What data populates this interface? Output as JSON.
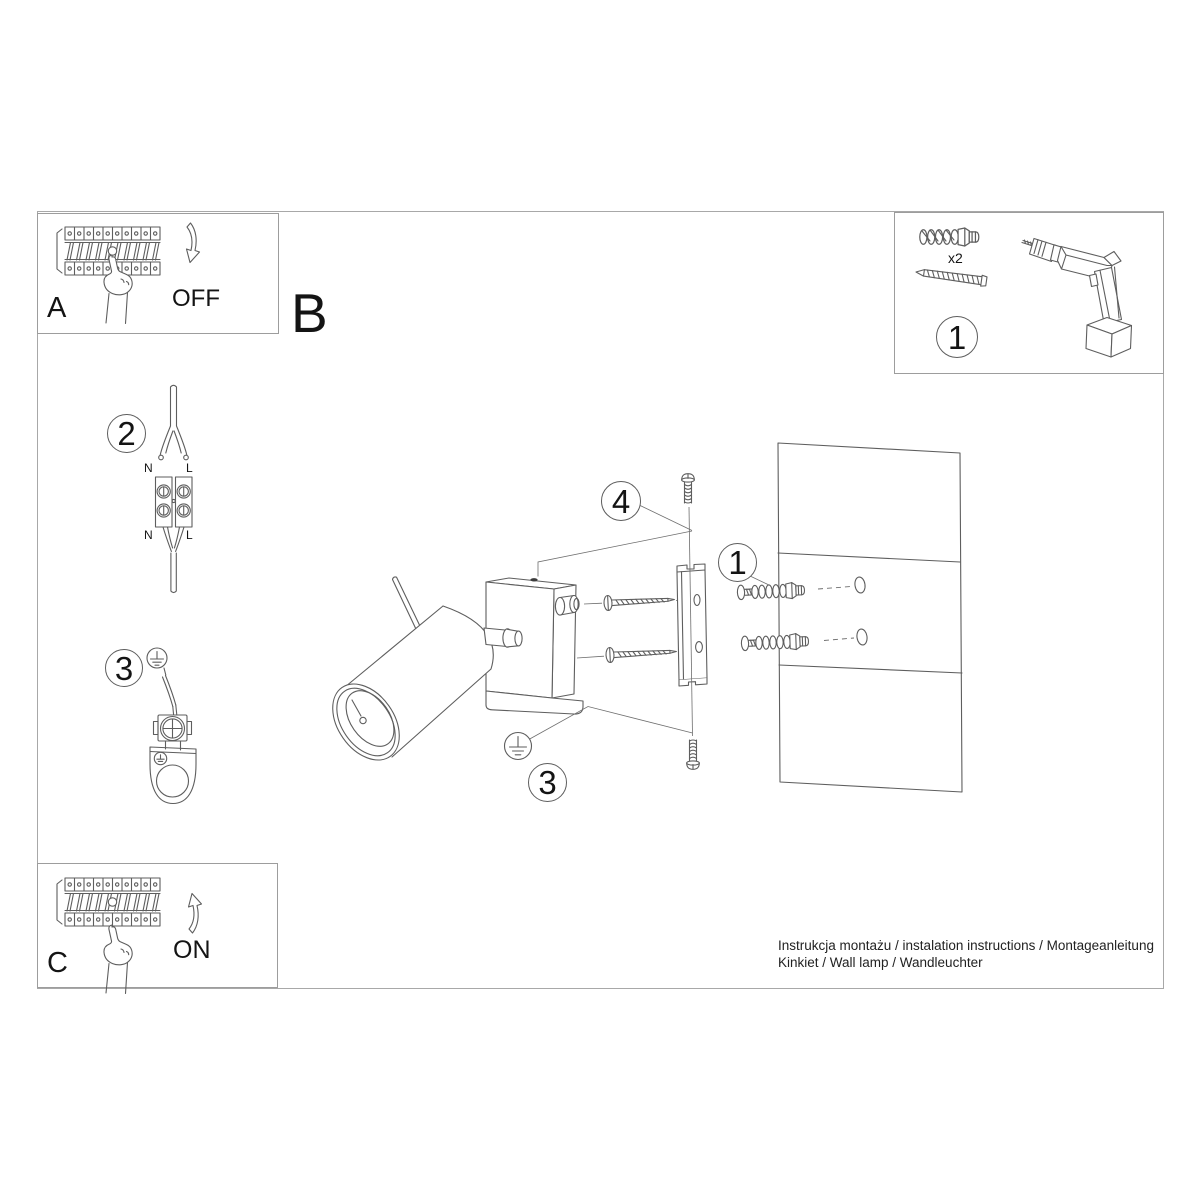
{
  "doc": {
    "title_line1": "Instrukcja montażu / instalation instructions / Montageanleitung",
    "title_line2": "Kinkiet / Wall lamp / Wandleuchter"
  },
  "labels": {
    "step_a": "A",
    "step_b": "B",
    "step_c": "C",
    "off": "OFF",
    "on": "ON",
    "qty": "x2",
    "n_top": "N",
    "l_top": "L",
    "n_bottom": "N",
    "l_bottom": "L"
  },
  "callouts": {
    "tools": "1",
    "wiring": "2",
    "earth_left": "3",
    "screw_top": "4",
    "anchors": "1",
    "earth_main": "3"
  },
  "colors": {
    "line": "#5e5e5e",
    "frame": "#a8a8a8",
    "text": "#161616"
  }
}
